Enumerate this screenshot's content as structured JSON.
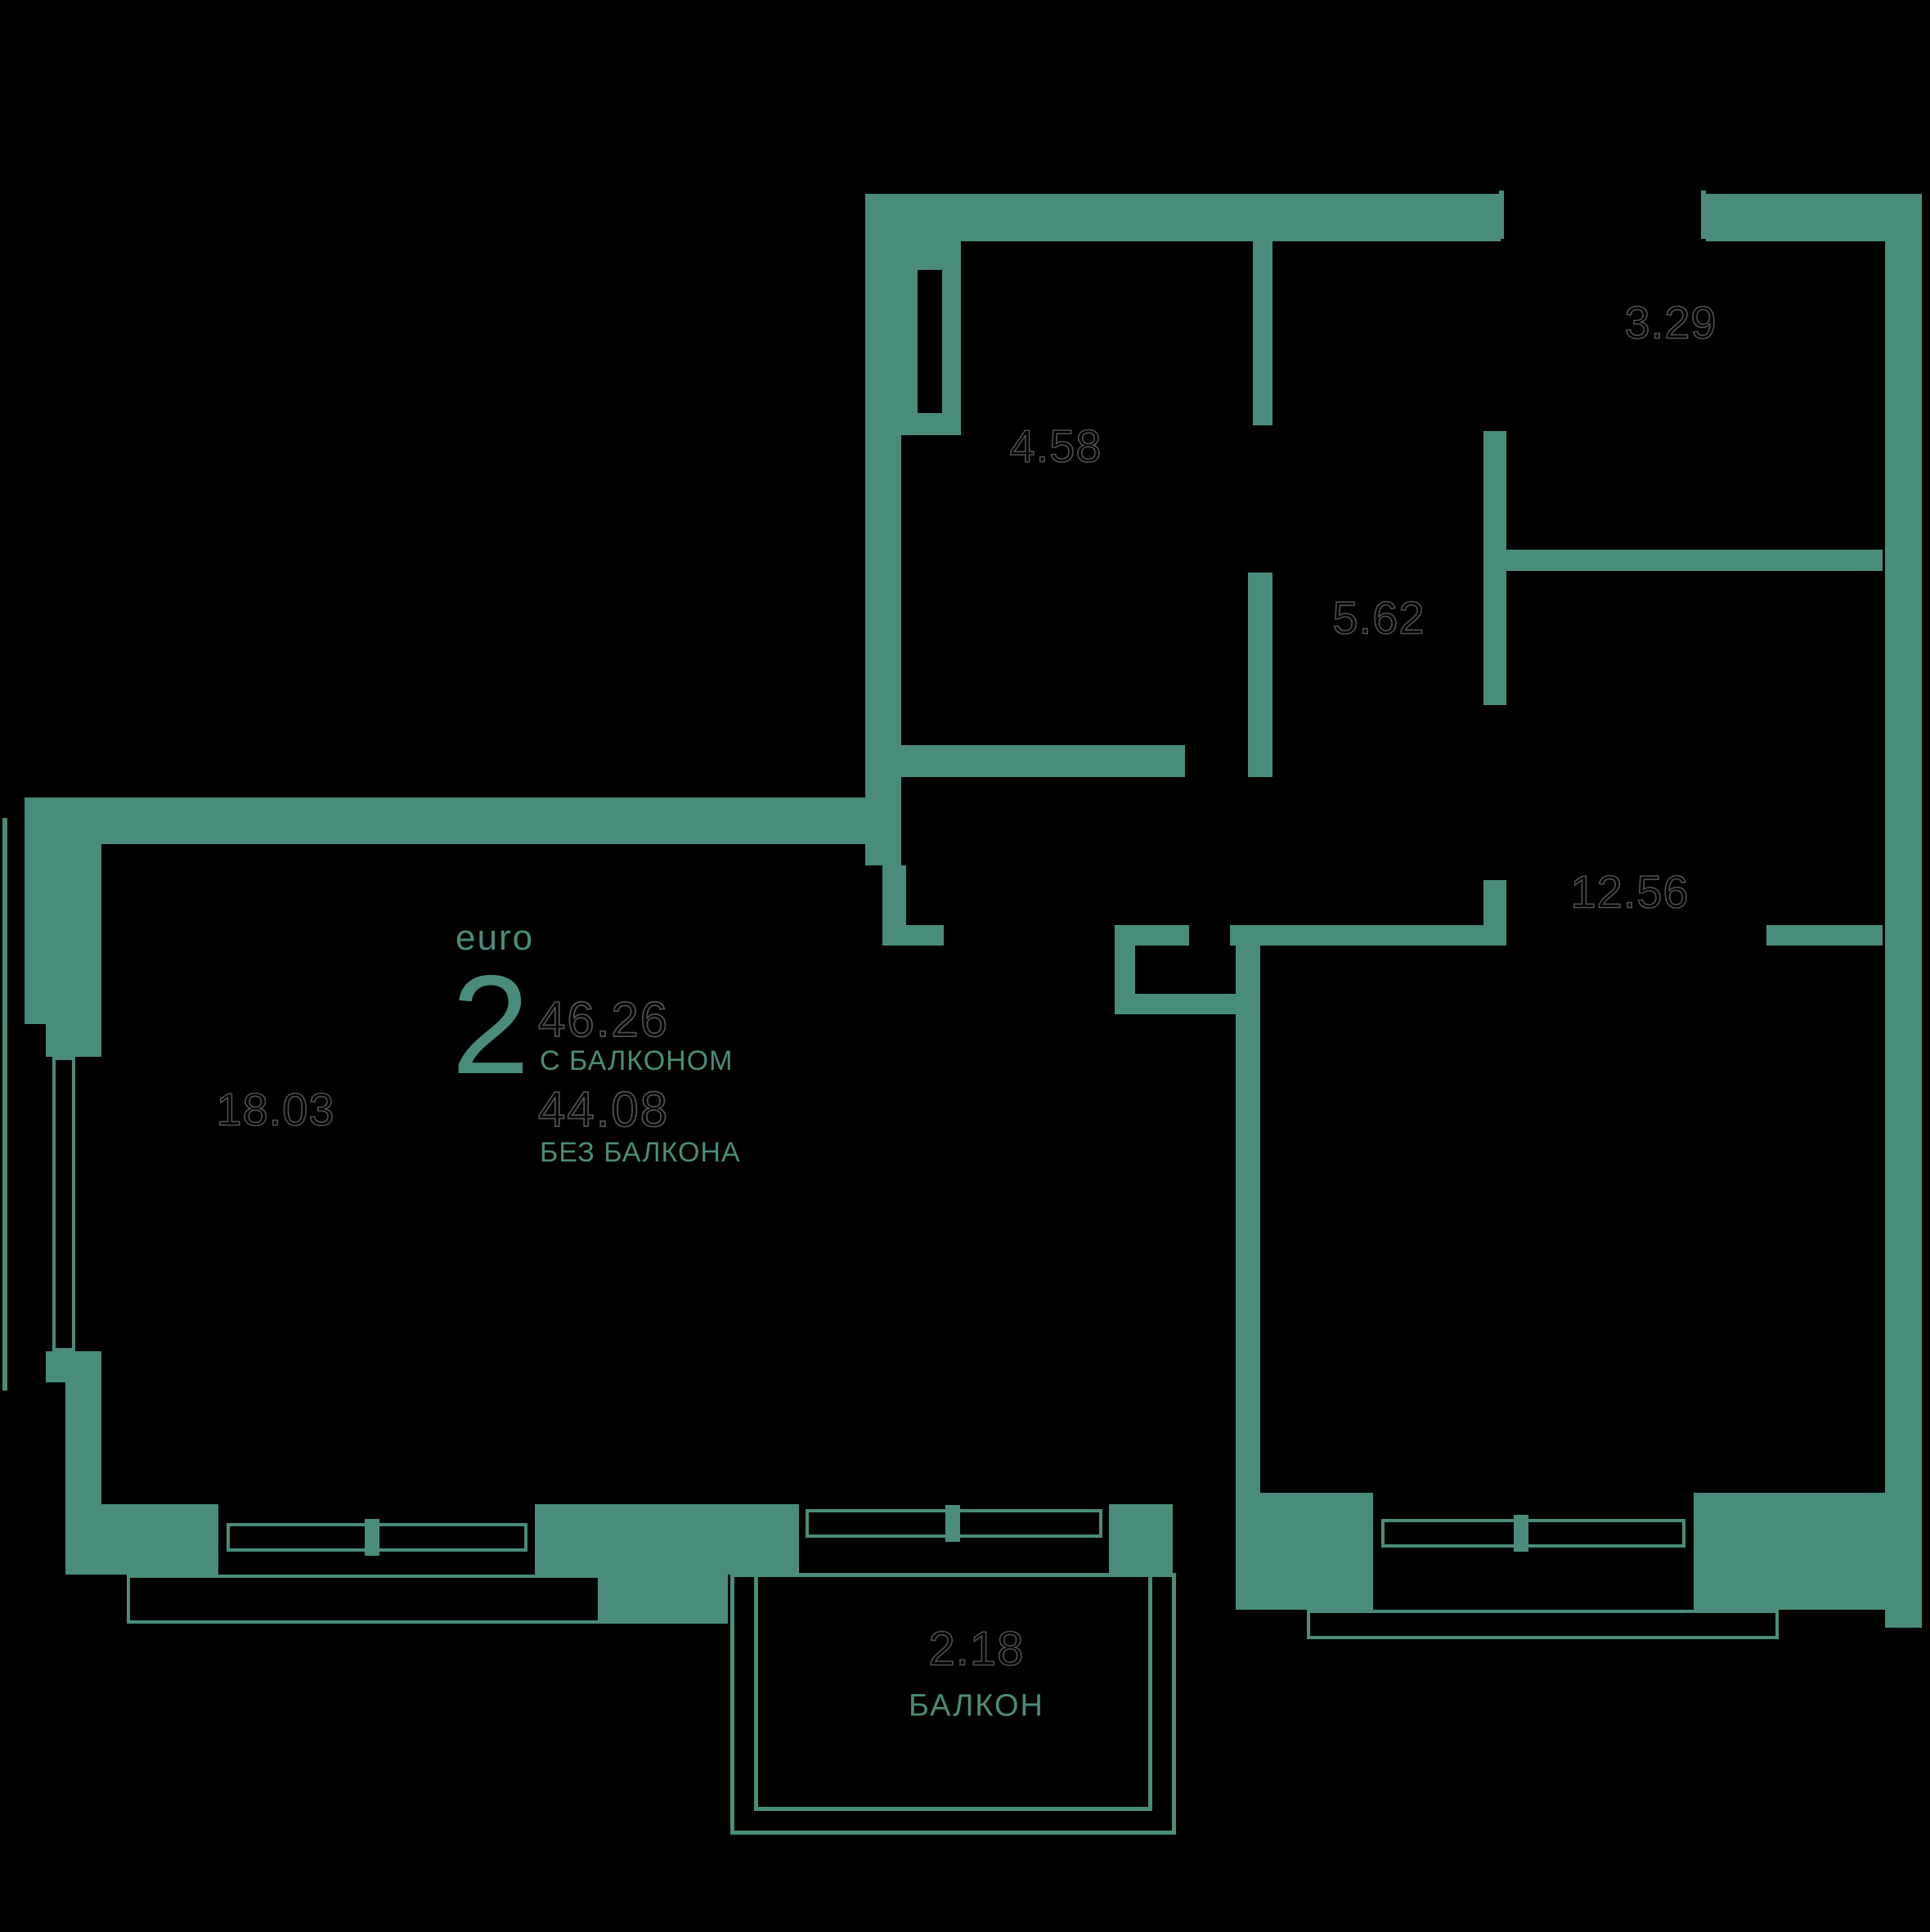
{
  "colors": {
    "background": "#000000",
    "wall_teal": "#4a8c7b",
    "room_number_outline": "#4d524f"
  },
  "legend": {
    "type_label": "euro",
    "type_number": "2",
    "area_with_balcony": "46.26",
    "with_balcony_label": "С БАЛКОНОМ",
    "area_without_balcony": "44.08",
    "without_balcony_label": "БЕЗ БАЛКОНА"
  },
  "rooms": {
    "storage": {
      "area": "4.58"
    },
    "wardrobe": {
      "area": "3.29"
    },
    "hallway": {
      "area": "5.62"
    },
    "bedroom": {
      "area": "12.56"
    },
    "living_room": {
      "area": "18.03"
    },
    "balcony": {
      "area": "2.18",
      "name": "БАЛКОН"
    }
  }
}
